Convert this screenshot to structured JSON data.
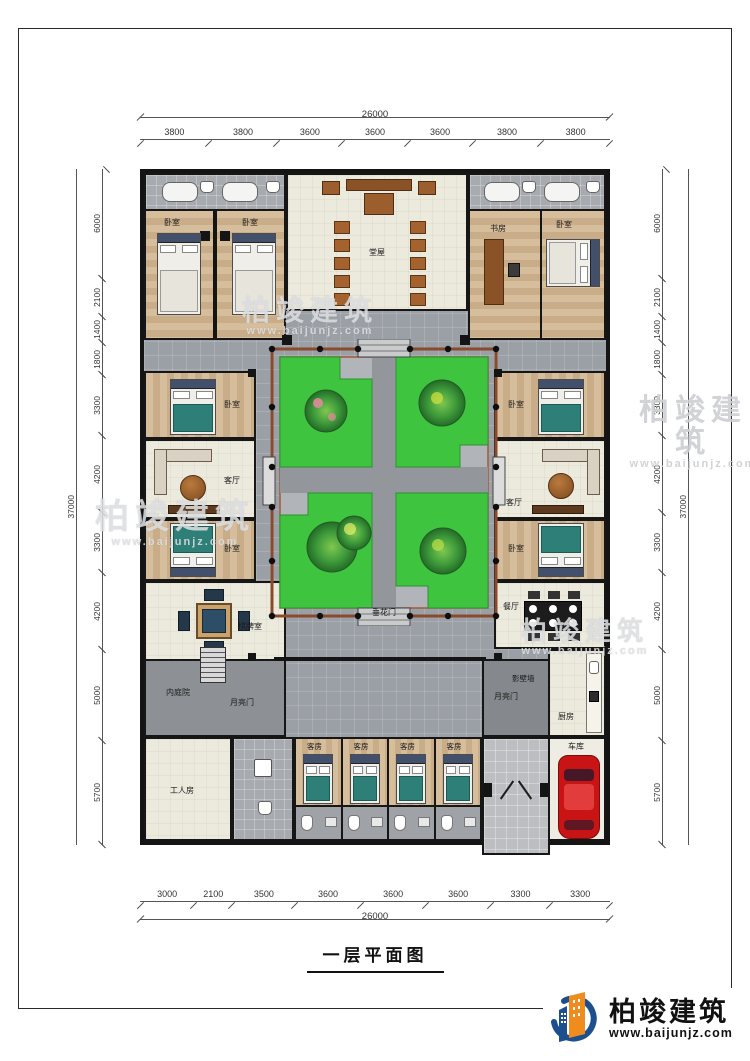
{
  "page_title": "一层平面图",
  "logo": {
    "brand": "柏竣建筑",
    "url": "www.baijunjz.com"
  },
  "watermark": {
    "brand": "柏竣建筑",
    "url": "www.baijunjz.com"
  },
  "dimensions": {
    "top": {
      "total": "26000",
      "segments": [
        "3800",
        "3800",
        "3600",
        "3600",
        "3600",
        "3800",
        "3800"
      ]
    },
    "bottom": {
      "total": "26000",
      "segments": [
        "3000",
        "2100",
        "3500",
        "3600",
        "3600",
        "3600",
        "3300",
        "3300"
      ]
    },
    "left": {
      "total": "37000",
      "segments": [
        "6000",
        "2100",
        "1400",
        "1800",
        "3300",
        "4200",
        "3300",
        "4200",
        "5000",
        "5700"
      ]
    },
    "right": {
      "total": "37000",
      "segments": [
        "6000",
        "2100",
        "1400",
        "1800",
        "3300",
        "4200",
        "3300",
        "4200",
        "5000",
        "5700"
      ]
    }
  },
  "rooms": {
    "bedroom": "卧室",
    "hall": "堂屋",
    "study": "书房",
    "living": "客厅",
    "mahjong": "棋牌室",
    "inner_courtyard": "内庭院",
    "moon_gate": "月亮门",
    "chuihua_gate": "垂花门",
    "screen_wall": "影壁墙",
    "dining": "餐厅",
    "kitchen": "厨房",
    "garage": "车库",
    "worker_room": "工人房"
  },
  "guest_rooms": [
    "客房",
    "客房",
    "客房",
    "客房"
  ]
}
